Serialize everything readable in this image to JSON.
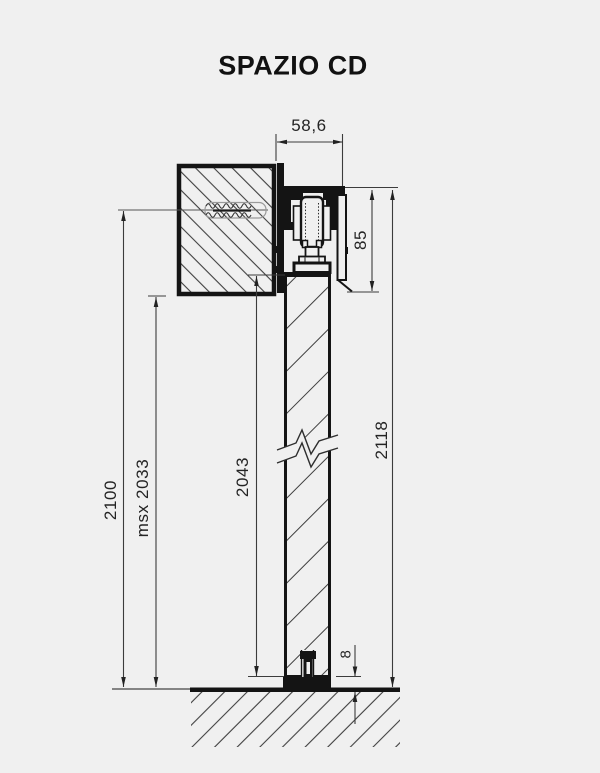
{
  "title": "SPAZIO CD",
  "dimensions": {
    "track_width": "58,6",
    "track_height": "85",
    "system_height": "2118",
    "door_height": "2043",
    "max_clearance": "msx 2033",
    "fixing_height": "2100",
    "floor_gap": "8"
  },
  "colors": {
    "background": "#f0f0f0",
    "ink": "#141414",
    "dimension_line": "#3c3c3c",
    "hatch": "#3f3f3f"
  }
}
